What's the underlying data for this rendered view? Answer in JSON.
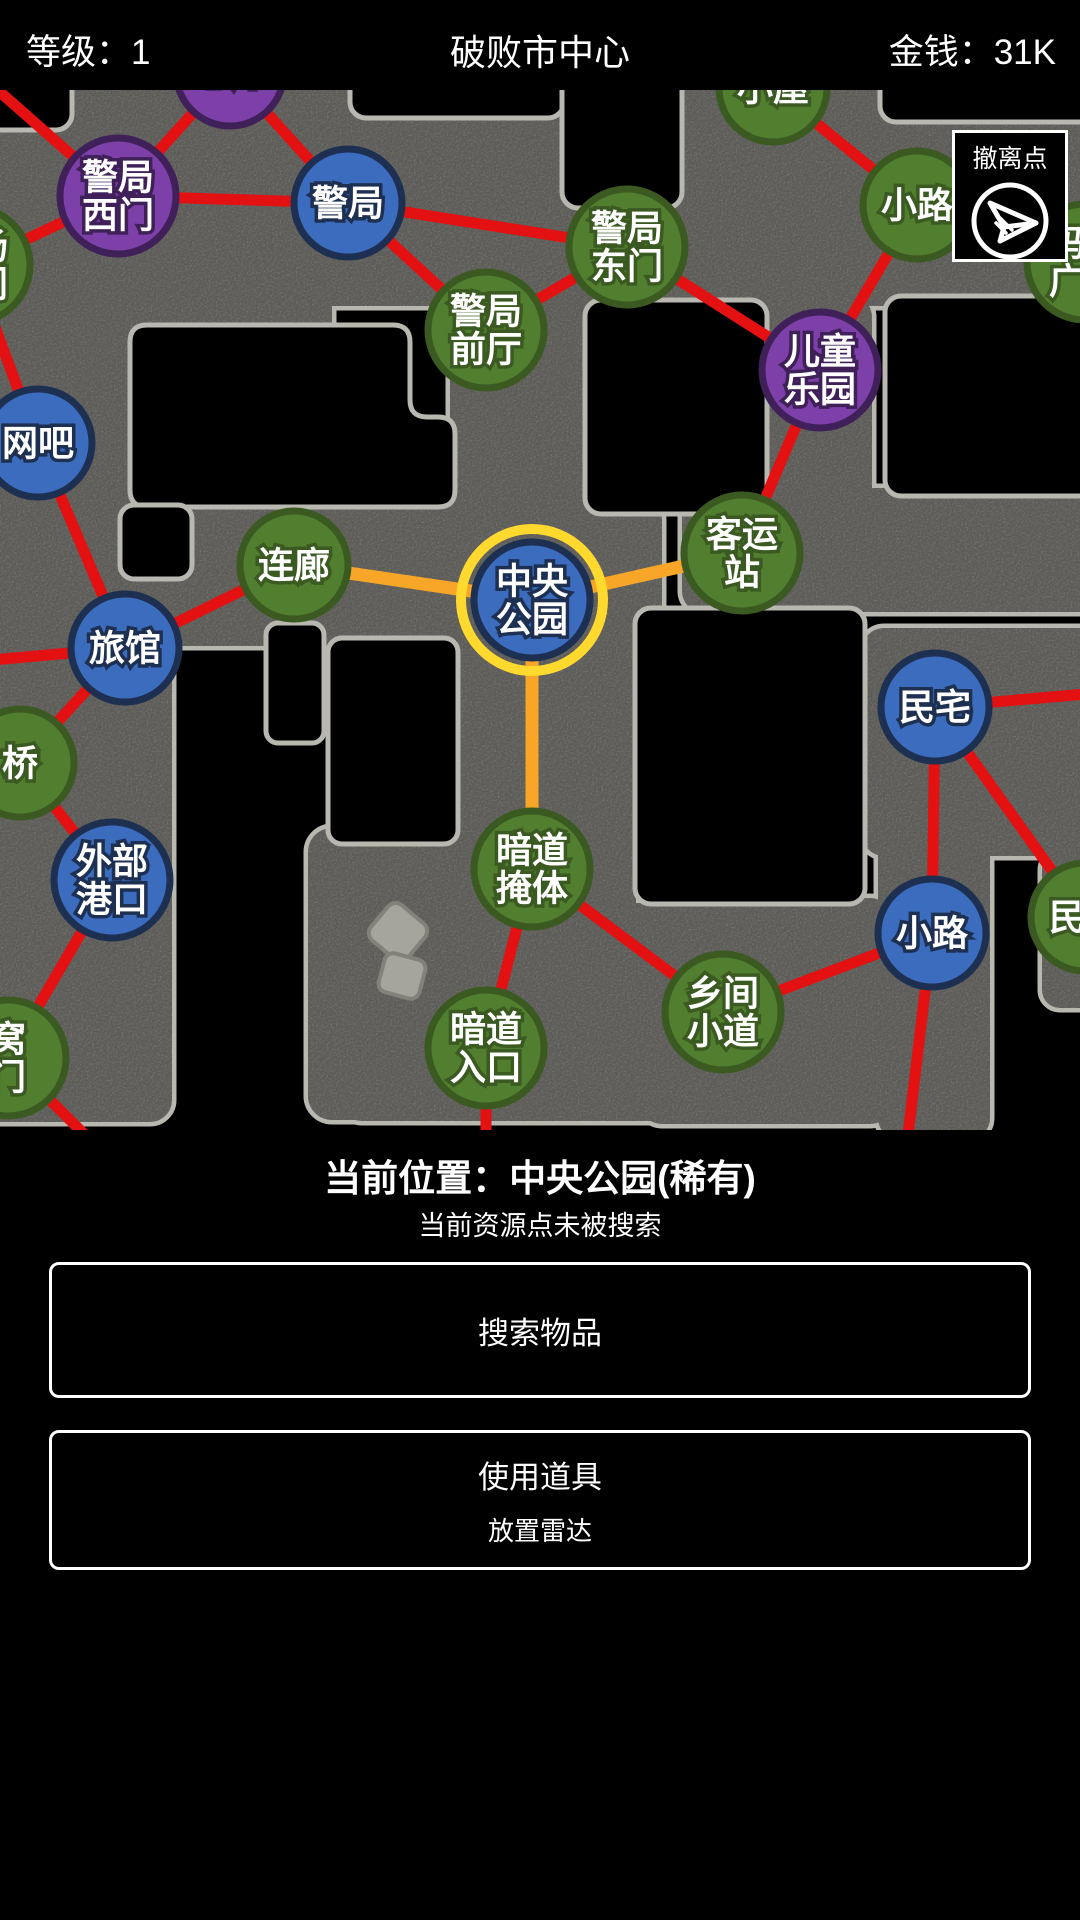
{
  "header": {
    "level_label": "等级：1",
    "title": "破败市中心",
    "money_label": "金钱：31K"
  },
  "map": {
    "evac_button_label": "撤离点",
    "colors": {
      "road": "#8e8d87",
      "road_border": "#b9b8b0",
      "red_edge": "#e31111",
      "orange_edge": "#f8a628",
      "ring_yellow": "#ffd92e",
      "green_fill": "#527e2f",
      "green_stroke": "#3a5a21",
      "blue_fill": "#3b6cbe",
      "blue_stroke": "#1e3052",
      "purple_fill": "#7d3fa8",
      "purple_stroke": "#3f2058"
    },
    "nodes": [
      {
        "id": "cangku",
        "x": 230,
        "y": 72,
        "type": "purple",
        "lines": [
          "仓库"
        ]
      },
      {
        "id": "jingju-ximen",
        "x": 118,
        "y": 196,
        "type": "purple",
        "lines": [
          "警局",
          "西门"
        ]
      },
      {
        "id": "jingju",
        "x": 348,
        "y": 203,
        "type": "blue",
        "lines": [
          "警局"
        ]
      },
      {
        "id": "xiaowu",
        "x": 773,
        "y": 88,
        "type": "green",
        "lines": [
          "小屋"
        ]
      },
      {
        "id": "jingju-dongmen",
        "x": 627,
        "y": 247,
        "type": "green",
        "lines": [
          "警局",
          "东门"
        ]
      },
      {
        "id": "jingju-qianting",
        "x": 486,
        "y": 330,
        "type": "green",
        "lines": [
          "警局",
          "前厅"
        ]
      },
      {
        "id": "xiaolu-top",
        "x": 917,
        "y": 205,
        "type": "green",
        "lines": [
          "小路"
        ]
      },
      {
        "id": "matou-guangchang",
        "x": 1085,
        "y": 262,
        "type": "green",
        "lines": [
          "码头",
          "广场"
        ]
      },
      {
        "id": "ertong-leyuan",
        "x": 820,
        "y": 370,
        "type": "purple",
        "lines": [
          "儿童",
          "乐园"
        ]
      },
      {
        "id": "guangchang-damen",
        "x": -28,
        "y": 265,
        "type": "green",
        "lines": [
          "广场",
          "大门"
        ]
      },
      {
        "id": "wangba",
        "x": 38,
        "y": 443,
        "type": "blue",
        "lines": [
          "网吧"
        ]
      },
      {
        "id": "lianlang",
        "x": 294,
        "y": 565,
        "type": "green",
        "lines": [
          "连廊"
        ]
      },
      {
        "id": "zhongyang-gongyuan",
        "x": 532,
        "y": 600,
        "type": "blue",
        "lines": [
          "中央",
          "公园"
        ],
        "current": true
      },
      {
        "id": "keyunzhan",
        "x": 742,
        "y": 553,
        "type": "green",
        "lines": [
          "客运",
          "站"
        ]
      },
      {
        "id": "lvguan",
        "x": 125,
        "y": 648,
        "type": "blue",
        "lines": [
          "旅馆"
        ]
      },
      {
        "id": "minzhai",
        "x": 935,
        "y": 707,
        "type": "blue",
        "lines": [
          "民宅"
        ]
      },
      {
        "id": "qiao",
        "x": 20,
        "y": 763,
        "type": "green",
        "lines": [
          "桥"
        ]
      },
      {
        "id": "waibu-gangkou",
        "x": 112,
        "y": 880,
        "type": "blue",
        "lines": [
          "外部",
          "港口"
        ]
      },
      {
        "id": "andao-yanti",
        "x": 532,
        "y": 869,
        "type": "green",
        "lines": [
          "暗道",
          "掩体"
        ]
      },
      {
        "id": "xiaolu-right",
        "x": 932,
        "y": 933,
        "type": "blue",
        "lines": [
          "小路"
        ]
      },
      {
        "id": "women",
        "x": 8,
        "y": 1058,
        "type": "green",
        "lines": [
          "窝",
          "门"
        ]
      },
      {
        "id": "andao-rukou",
        "x": 486,
        "y": 1048,
        "type": "green",
        "lines": [
          "暗道",
          "入口"
        ]
      },
      {
        "id": "xiangjian-xiaodao",
        "x": 723,
        "y": 1012,
        "type": "green",
        "lines": [
          "乡间",
          "小道"
        ]
      },
      {
        "id": "minzhai-right",
        "x": 1085,
        "y": 917,
        "type": "green",
        "lines": [
          "民宅"
        ]
      }
    ],
    "edges": [
      {
        "x1": -25,
        "y1": 70,
        "x2": 118,
        "y2": 196,
        "c": "red"
      },
      {
        "x1": 230,
        "y1": 72,
        "x2": 118,
        "y2": 196,
        "c": "red"
      },
      {
        "x1": 230,
        "y1": 72,
        "x2": 348,
        "y2": 203,
        "c": "red"
      },
      {
        "x1": 118,
        "y1": 196,
        "x2": 348,
        "y2": 203,
        "c": "red"
      },
      {
        "x1": -28,
        "y1": 265,
        "x2": 118,
        "y2": 196,
        "c": "red"
      },
      {
        "x1": -28,
        "y1": 265,
        "x2": 38,
        "y2": 443,
        "c": "red"
      },
      {
        "x1": 348,
        "y1": 203,
        "x2": 627,
        "y2": 247,
        "c": "red"
      },
      {
        "x1": 348,
        "y1": 203,
        "x2": 486,
        "y2": 330,
        "c": "red"
      },
      {
        "x1": 486,
        "y1": 330,
        "x2": 627,
        "y2": 247,
        "c": "red"
      },
      {
        "x1": 627,
        "y1": 247,
        "x2": 820,
        "y2": 370,
        "c": "red"
      },
      {
        "x1": 773,
        "y1": 88,
        "x2": 917,
        "y2": 205,
        "c": "red"
      },
      {
        "x1": 917,
        "y1": 205,
        "x2": 820,
        "y2": 370,
        "c": "red"
      },
      {
        "x1": 917,
        "y1": 205,
        "x2": 1085,
        "y2": 262,
        "c": "red"
      },
      {
        "x1": 820,
        "y1": 370,
        "x2": 742,
        "y2": 553,
        "c": "red"
      },
      {
        "x1": 38,
        "y1": 443,
        "x2": 125,
        "y2": 648,
        "c": "red"
      },
      {
        "x1": 125,
        "y1": 648,
        "x2": 294,
        "y2": 565,
        "c": "red"
      },
      {
        "x1": 125,
        "y1": 648,
        "x2": 20,
        "y2": 763,
        "c": "red"
      },
      {
        "x1": -30,
        "y1": 662,
        "x2": 125,
        "y2": 648,
        "c": "red"
      },
      {
        "x1": 20,
        "y1": 763,
        "x2": 112,
        "y2": 880,
        "c": "red"
      },
      {
        "x1": 112,
        "y1": 880,
        "x2": 8,
        "y2": 1058,
        "c": "red"
      },
      {
        "x1": 8,
        "y1": 1058,
        "x2": 85,
        "y2": 1135,
        "c": "red"
      },
      {
        "x1": 532,
        "y1": 869,
        "x2": 486,
        "y2": 1048,
        "c": "red"
      },
      {
        "x1": 532,
        "y1": 869,
        "x2": 723,
        "y2": 1012,
        "c": "red"
      },
      {
        "x1": 486,
        "y1": 1048,
        "x2": 486,
        "y2": 1135,
        "c": "red"
      },
      {
        "x1": 723,
        "y1": 1012,
        "x2": 932,
        "y2": 933,
        "c": "red"
      },
      {
        "x1": 932,
        "y1": 933,
        "x2": 935,
        "y2": 707,
        "c": "red"
      },
      {
        "x1": 935,
        "y1": 707,
        "x2": 1110,
        "y2": 692,
        "c": "red"
      },
      {
        "x1": 935,
        "y1": 707,
        "x2": 1085,
        "y2": 917,
        "c": "red"
      },
      {
        "x1": 932,
        "y1": 933,
        "x2": 908,
        "y2": 1135,
        "c": "red"
      },
      {
        "x1": 294,
        "y1": 565,
        "x2": 532,
        "y2": 600,
        "c": "orange"
      },
      {
        "x1": 532,
        "y1": 600,
        "x2": 742,
        "y2": 553,
        "c": "orange"
      },
      {
        "x1": 532,
        "y1": 600,
        "x2": 532,
        "y2": 869,
        "c": "orange"
      }
    ]
  },
  "status": {
    "location_line": "当前位置：中央公园(稀有)",
    "search_line": "当前资源点未被搜索"
  },
  "actions": {
    "search_button": "搜索物品",
    "use_item_button": "使用道具",
    "use_item_sub": "放置雷达"
  }
}
